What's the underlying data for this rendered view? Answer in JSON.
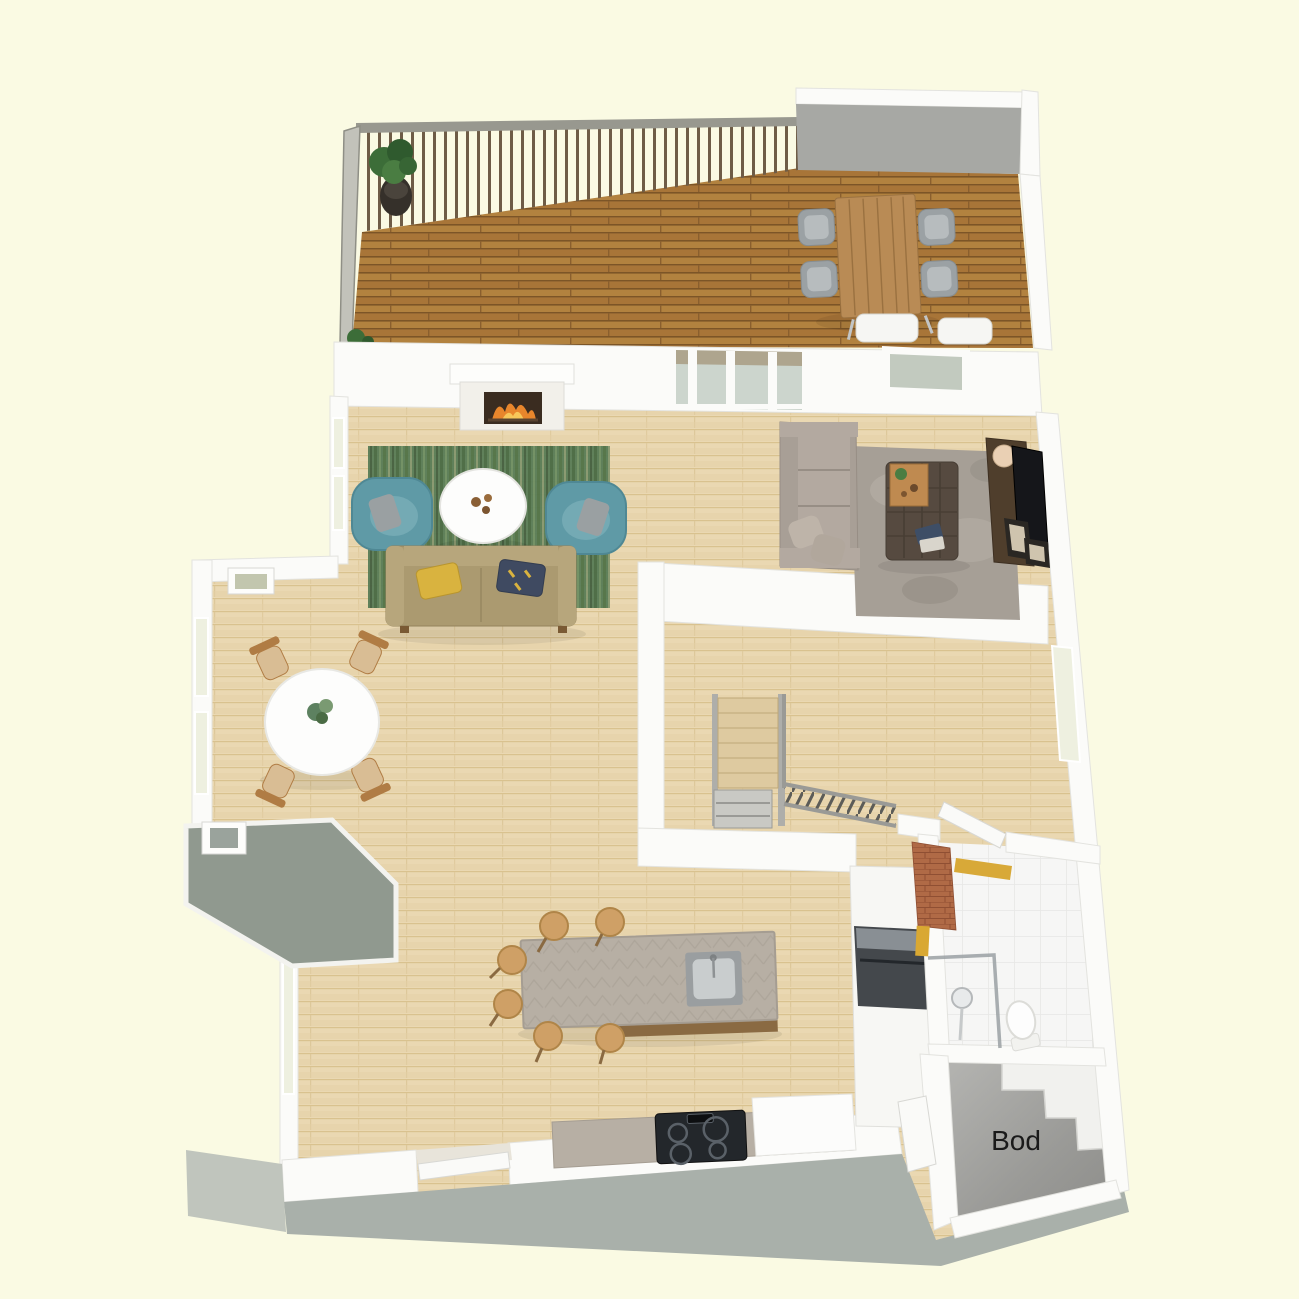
{
  "scene": {
    "type": "3d-floor-plan-render",
    "view": "top-down isometric",
    "background": "#FAFAE3"
  },
  "labels": {
    "storage_room": "Bod"
  },
  "rooms": [
    {
      "name": "deck-terrace",
      "floor": "dark wood planks",
      "features": [
        "railing",
        "potted-plant",
        "outdoor-dining-table",
        "outdoor-chairs-x4"
      ]
    },
    {
      "name": "living-room",
      "floor": "light oak",
      "features": [
        "fireplace",
        "green-striped-rug",
        "round-coffee-table",
        "teal-armchair-x2",
        "tan-sofa"
      ]
    },
    {
      "name": "tv-lounge",
      "floor": "light oak",
      "features": [
        "corner-sofa",
        "shag-rug",
        "tufted-ottoman",
        "media-console",
        "tv",
        "lamp"
      ]
    },
    {
      "name": "dining-area",
      "floor": "light oak",
      "features": [
        "round-dining-table",
        "wood-chair-x4",
        "bay-windows"
      ]
    },
    {
      "name": "kitchen",
      "floor": "light oak",
      "features": [
        "island-with-sink",
        "stool-x6",
        "cooktop-counter",
        "tall-cabinet-with-oven",
        "fridge"
      ]
    },
    {
      "name": "hallway-stairs",
      "floor": "light oak",
      "features": [
        "staircase",
        "stair-railing",
        "window"
      ]
    },
    {
      "name": "bathroom",
      "floor": "white tile",
      "features": [
        "shower",
        "toilet",
        "copper-chimney",
        "door"
      ]
    },
    {
      "name": "storage",
      "label": "Bod",
      "floor": "concrete",
      "features": [
        "stair-bulkhead-steps",
        "door"
      ]
    }
  ],
  "colors": {
    "background": "#FAFAE3",
    "deck_wood": "#b2823f",
    "interior_wood": "#ead8b2",
    "wall": "#fbfbf9",
    "wall_shadow": "#a7a8a4",
    "rug_green": "#5a7d57",
    "armchair_teal": "#5f9aa6",
    "sofa_tan": "#ab9a70",
    "pillow_yellow": "#d9b33f",
    "pillow_navy": "#3f4a61",
    "lounge_sofa": "#a89f96",
    "shag_rug": "#a69f96",
    "ottoman": "#564a40",
    "tray_wood": "#bf8a50",
    "console": "#4f3e2c",
    "tv": "#15161a",
    "lamp": "#ead0b4",
    "island_top": "#b7afa4",
    "stool": "#cfa066",
    "cooktop": "#23272b",
    "oven": "#44484c",
    "brick_copper": "#b06a46",
    "cabinet_yellow": "#d9a832",
    "concrete": "#a0a09e",
    "stair_wood": "#decaa0",
    "fire": "#e8862c",
    "table_white": "#fdfdfc",
    "chair_wood": "#b07c44",
    "porch_roof": "#90998f",
    "exterior_band": "#a9b0aa",
    "label": "#1a1a1a"
  }
}
